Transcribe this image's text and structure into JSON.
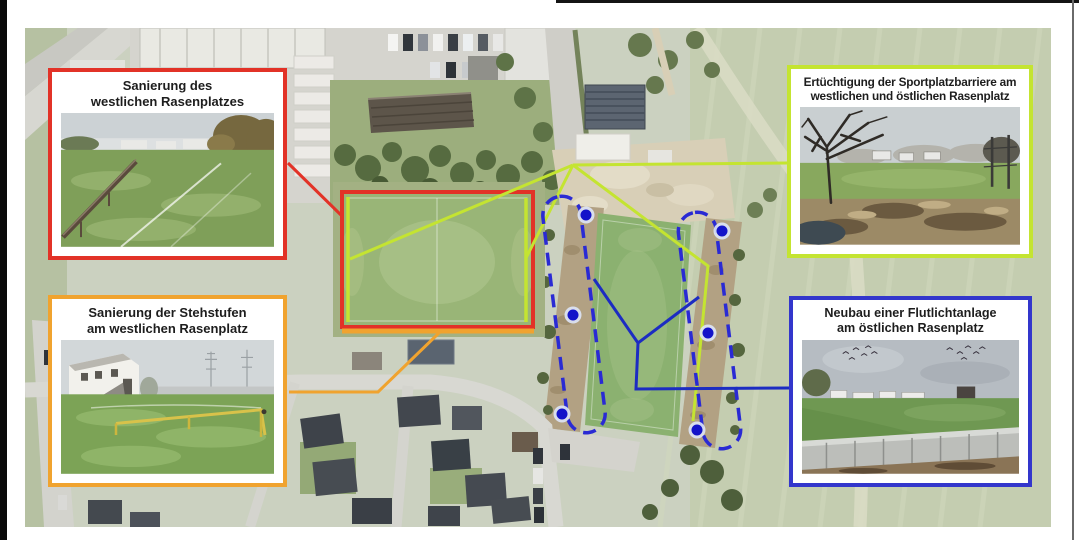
{
  "figure": {
    "kind": "Sportanlagen-Sanierungsplan auf Luftbild",
    "language": "de"
  },
  "callouts": [
    {
      "id": "sanierung-west-rasenplatz",
      "accent_color": "#e23227",
      "title": [
        "Sanierung des",
        "westlichen Rasenplatzes"
      ],
      "photo_alt": "Rasenplatz mit Barriere"
    },
    {
      "id": "ertuechtigung-sportplatzbarriere",
      "accent_color": "#c4e431",
      "title": [
        "Ertüchtigung der Sportplatzbarriere am",
        "westlichen und östlichen Rasenplatz"
      ],
      "photo_alt": "Wiese mit kahlem Baum und Barriere"
    },
    {
      "id": "sanierung-stehstufen",
      "accent_color": "#f0a32f",
      "title": [
        "Sanierung der Stehstufen",
        "am westlichen Rasenplatz"
      ],
      "photo_alt": "Vereinsheim mit Geländer am Rasenplatz"
    },
    {
      "id": "neubau-flutlichtanlage",
      "accent_color": "#3336cc",
      "title": [
        "Neubau einer Flutlichtanlage",
        "am östlichen Rasenplatz"
      ],
      "photo_alt": "Rasenplatz mit Betonbarriere"
    }
  ],
  "map": {
    "overlays": [
      {
        "name": "west-pitch-outline",
        "color": "#e23227",
        "style": "solid-rectangle"
      },
      {
        "name": "stehstufen-line",
        "color": "#f0a32f",
        "style": "solid-line-south-edge"
      },
      {
        "name": "sportplatzbarriere-lines",
        "color": "#c4e431",
        "style": "solid-lines-pitch-sides"
      },
      {
        "name": "flutlicht-strips",
        "color": "#2a2ad4",
        "style": "dashed-rounded-outlines",
        "floodlight_dots": 6
      }
    ]
  }
}
